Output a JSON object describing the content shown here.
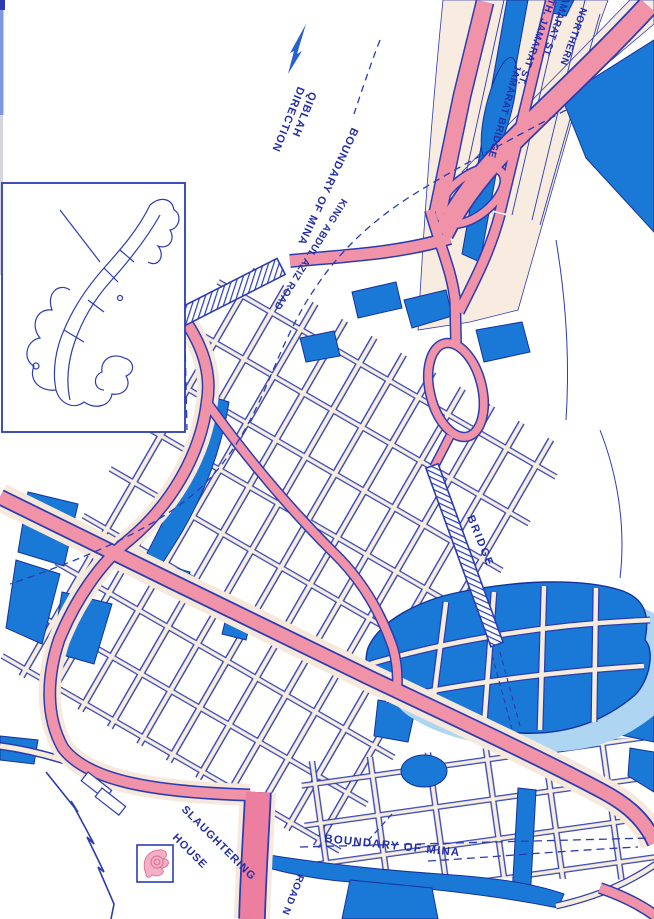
{
  "labels": {
    "qiblah_line1": "QIBLAH",
    "qiblah_line2": "DIRECTION",
    "boundary_of_mina_upper": "BOUNDARY OF MINA",
    "king_abdul_aziz_road": "KING ABDUL AZIZ ROAD",
    "northern_jamarat_line1": "NORTHERN",
    "northern_jamarat_line2": "JAMARAT ST.",
    "south_jamarat_partial": "TH. JAMARAT ST.",
    "jamarat_bridge": "JAMARAT BRIDGE",
    "bridge": "BRIDGE",
    "slaughtering_house_line1": "SLAUGHTERING",
    "slaughtering_house_line2": "HOUSE",
    "boundary_of_mina_lower": "BOUNDARY OF MINA",
    "road_label_partial": "ROAD N"
  },
  "icons": {
    "qiblah_arrow": "compass-needle-arrow",
    "slaughtering_house": "slaughter-house-symbol",
    "bridge_hatch": "hatched-bridge-band",
    "inset": "overview-inset-map"
  },
  "colors": {
    "line_blue": "#2b3cb2",
    "text_blue": "#232fa8",
    "area_blue": "#1a79d6",
    "area_blue_light": "#aed6f2",
    "road_pink": "#f093a9",
    "road_pink_dark": "#ec7f9f",
    "street_cream": "#f6ecdc",
    "background": "#ffffff"
  }
}
